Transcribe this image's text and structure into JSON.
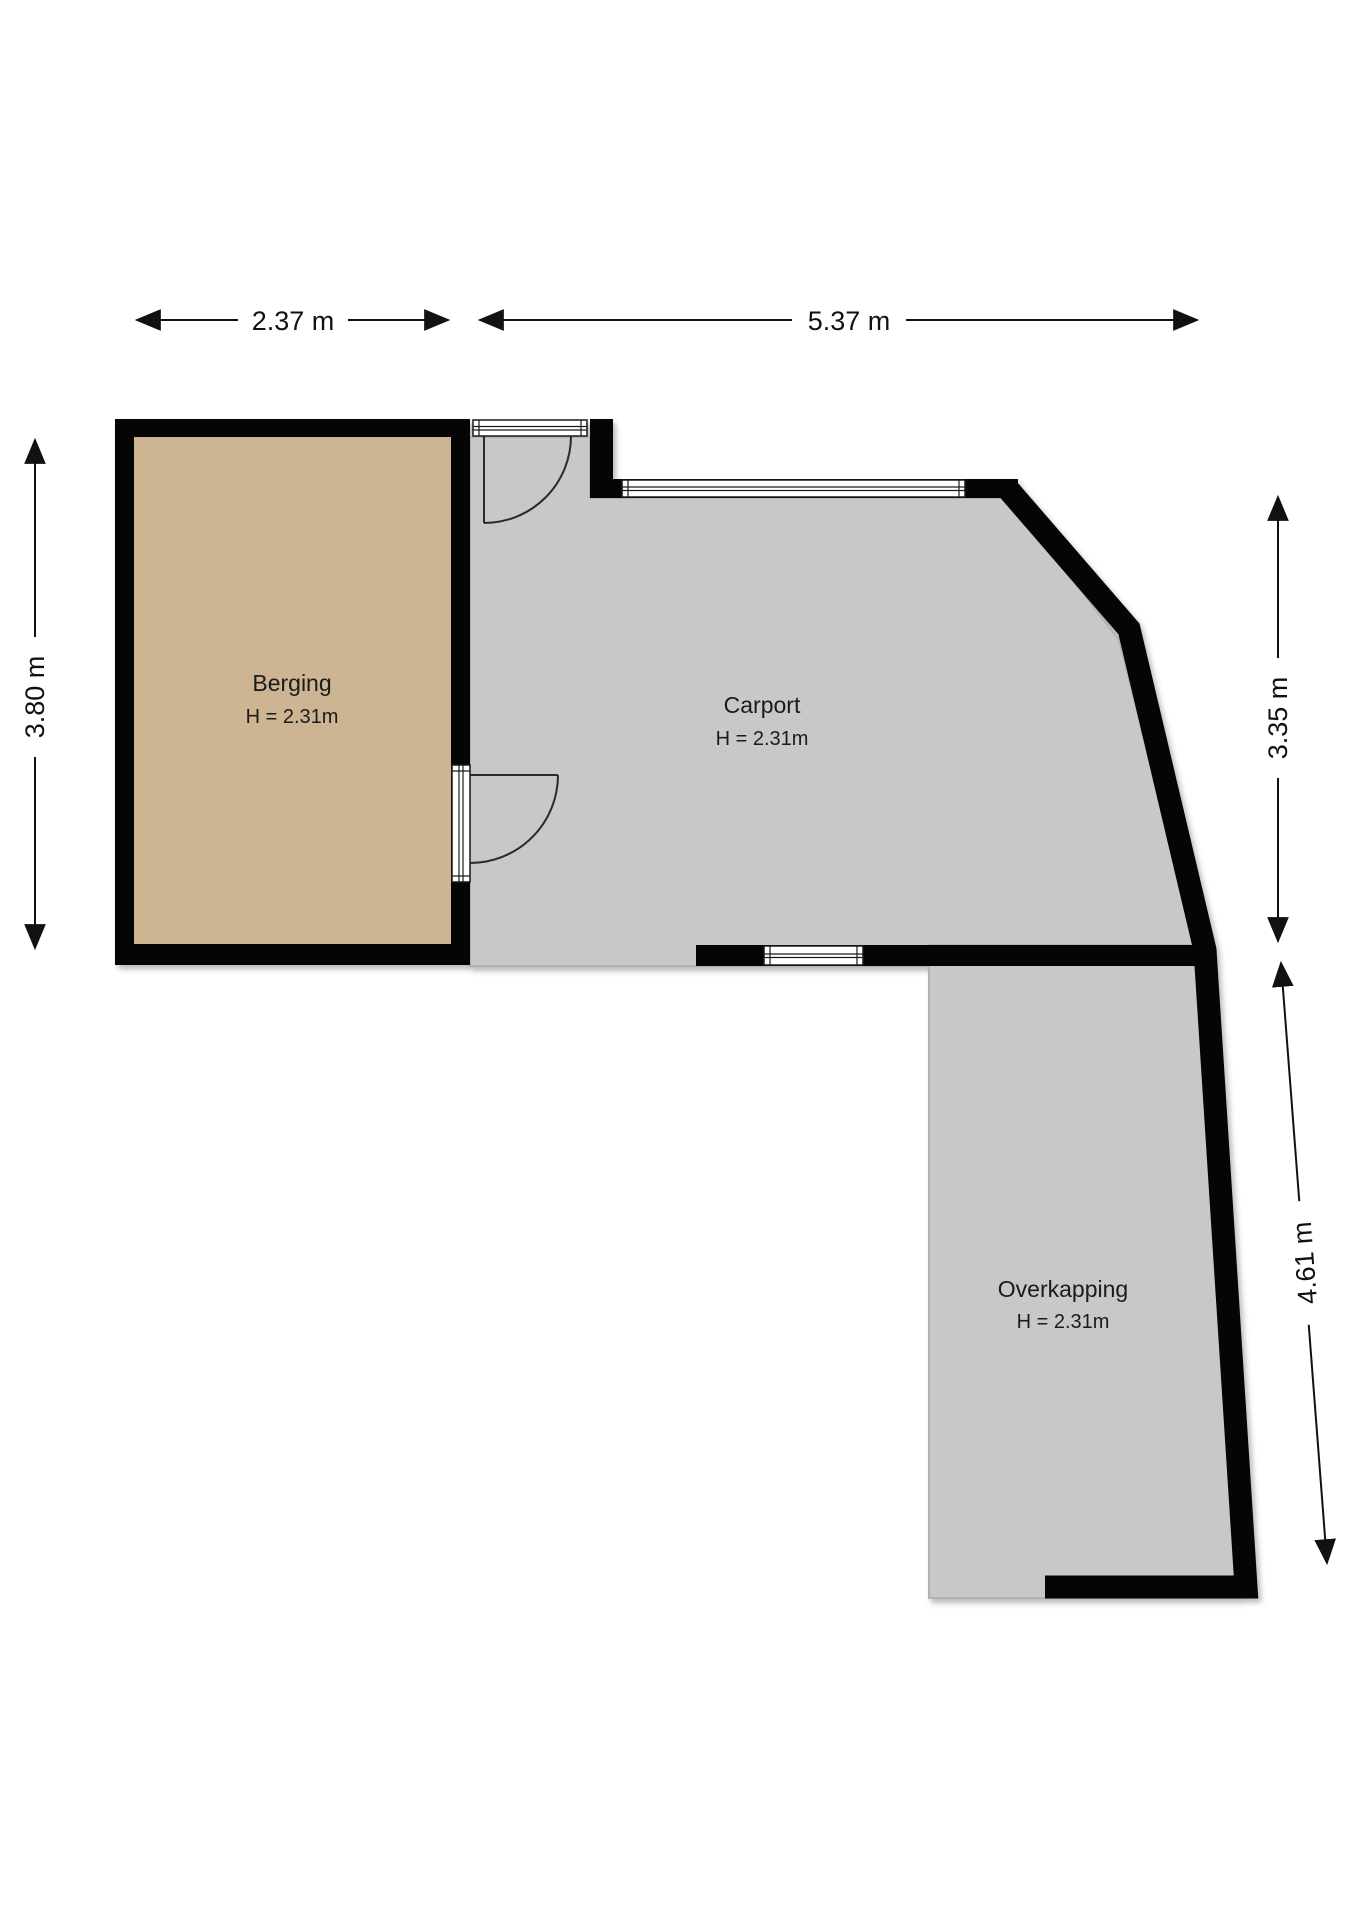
{
  "plan": {
    "rooms": [
      {
        "name": "Berging",
        "height_label": "H = 2.31m"
      },
      {
        "name": "Carport",
        "height_label": "H = 2.31m"
      },
      {
        "name": "Overkapping",
        "height_label": "H = 2.31m"
      }
    ],
    "dimensions": {
      "top_left": "2.37 m",
      "top_right": "5.37 m",
      "left": "3.80 m",
      "right_upper": "3.35 m",
      "right_lower": "4.61 m"
    },
    "colors": {
      "background": "#ffffff",
      "room_fill": "#cdb492",
      "covered_fill": "#c8c8c8",
      "floor_edge": "#b2b2b2",
      "wall": "#050505"
    }
  }
}
